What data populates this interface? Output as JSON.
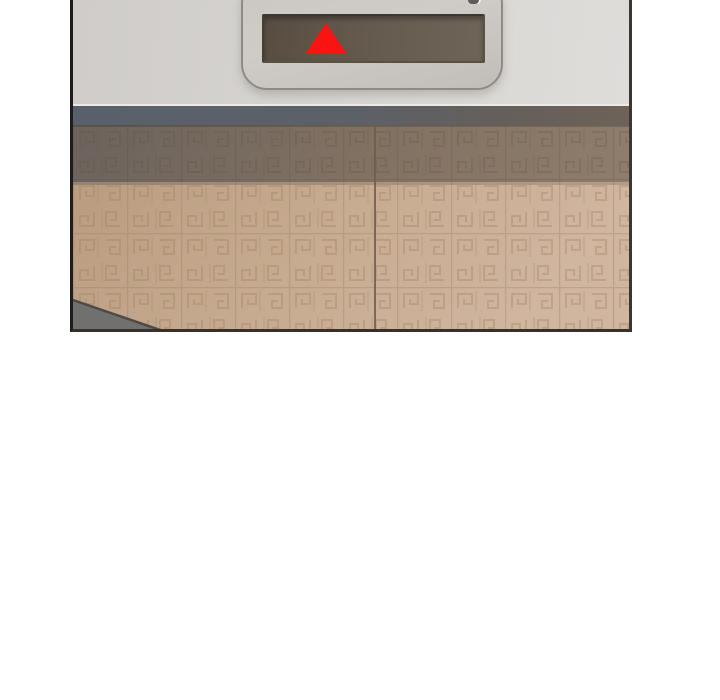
{
  "page": {
    "background_color": "#ffffff"
  },
  "panel": {
    "type": "webtoon-panel",
    "description": "Elevator hall scene: a floor-indicator display showing a red up arrow, mounted on a light grey wall above closed elevator doors covered in a greek-key patterned beige finish",
    "border_color": "#2b2826"
  },
  "indicator": {
    "direction": "up",
    "arrow": {
      "icon": "up-triangle-icon",
      "color": "#f91414"
    },
    "screen": {
      "color_left": "#584d41",
      "color_right": "#6e6457",
      "border_color": "#3e372e"
    },
    "plate": {
      "color": "#cbc7c3",
      "outline_color": "#8e8a85"
    }
  },
  "environment": {
    "upper_wall_color": "#d6d4d1",
    "lintel_band": {
      "left_color": "#58616b",
      "right_color": "#6d6257"
    },
    "doors": {
      "base_color_left": "#b79a7e",
      "base_color_right": "#d0b59f",
      "pattern": "greek-key tiles",
      "pattern_line_color": "#9c7f62",
      "center_seam_color": "#6d5c4b",
      "shadow_overlay_left": "rgba(32,44,58,0.50)",
      "shadow_overlay_right": "rgba(62,56,48,0.48)"
    },
    "floor_wedge": {
      "color": "#70706e",
      "edge_color": "#4e4a47"
    }
  }
}
